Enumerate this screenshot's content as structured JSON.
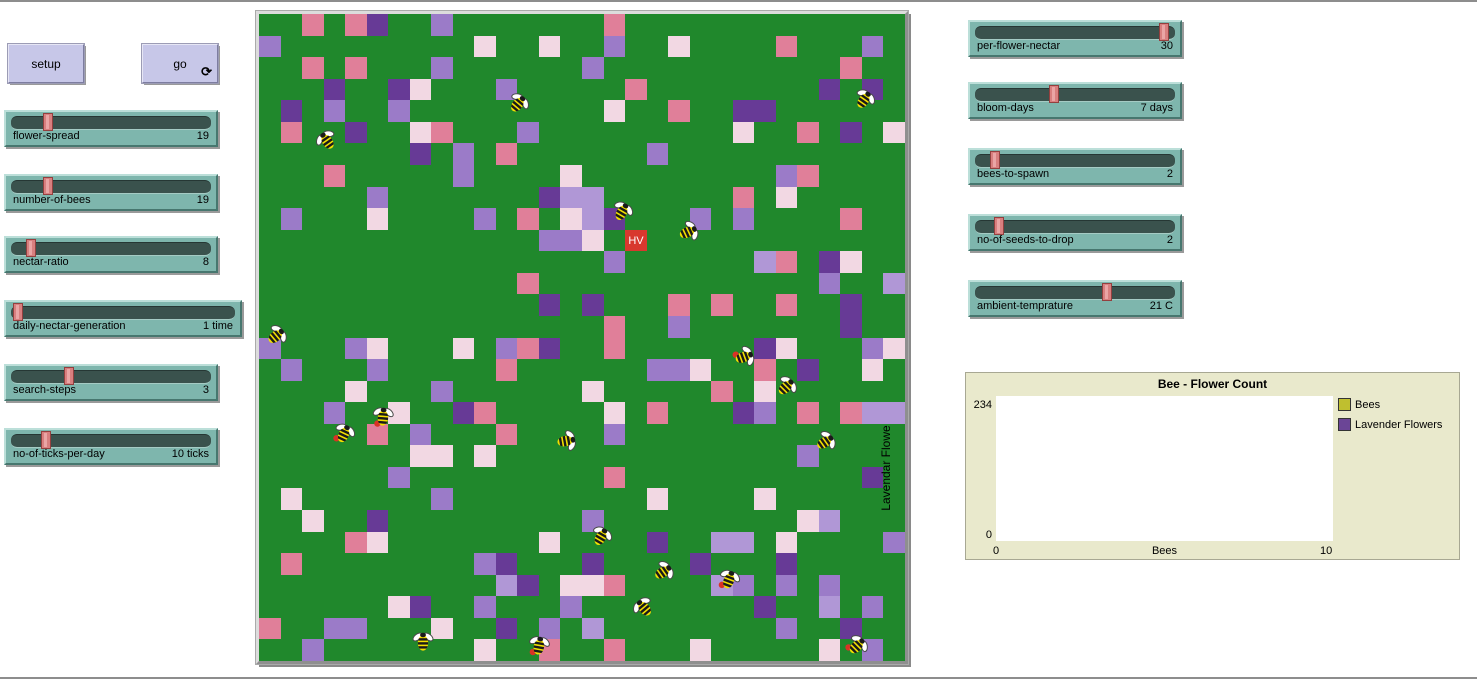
{
  "chrome": {
    "border_color": "#8d8d8d",
    "top_rule_y": 0,
    "bottom_rule_y": 677
  },
  "buttons": [
    {
      "id": "setup",
      "label": "setup",
      "x": 8,
      "y": 44,
      "w": 74,
      "h": 37,
      "forever": false,
      "forever_icon": ""
    },
    {
      "id": "go",
      "label": "go",
      "x": 142,
      "y": 44,
      "w": 74,
      "h": 37,
      "forever": true,
      "forever_icon": "⟳"
    }
  ],
  "sliders": [
    {
      "id": "flower-spread",
      "label": "flower-spread",
      "value": "19",
      "fraction": 0.17,
      "x": 4,
      "y": 110,
      "w": 214
    },
    {
      "id": "number-of-bees",
      "label": "number-of-bees",
      "value": "19",
      "fraction": 0.17,
      "x": 4,
      "y": 174,
      "w": 214
    },
    {
      "id": "nectar-ratio",
      "label": "nectar-ratio",
      "value": "8",
      "fraction": 0.08,
      "x": 4,
      "y": 236,
      "w": 214
    },
    {
      "id": "daily-nectar-generation",
      "label": "daily-nectar-generation",
      "value": "1 time",
      "fraction": 0.01,
      "x": 4,
      "y": 300,
      "w": 238
    },
    {
      "id": "search-steps",
      "label": "search-steps",
      "value": "3",
      "fraction": 0.28,
      "x": 4,
      "y": 364,
      "w": 214
    },
    {
      "id": "no-of-ticks-per-day",
      "label": "no-of-ticks-per-day",
      "value": "10 ticks",
      "fraction": 0.16,
      "x": 4,
      "y": 428,
      "w": 214
    },
    {
      "id": "per-flower-nectar",
      "label": "per-flower-nectar",
      "value": "30",
      "fraction": 0.97,
      "x": 968,
      "y": 20,
      "w": 214
    },
    {
      "id": "bloom-days",
      "label": "bloom-days",
      "value": "7 days",
      "fraction": 0.39,
      "x": 968,
      "y": 82,
      "w": 214
    },
    {
      "id": "bees-to-spawn",
      "label": "bees-to-spawn",
      "value": "2",
      "fraction": 0.08,
      "x": 968,
      "y": 148,
      "w": 214
    },
    {
      "id": "no-of-seeds-to-drop",
      "label": "no-of-seeds-to-drop",
      "value": "2",
      "fraction": 0.1,
      "x": 968,
      "y": 214,
      "w": 214
    },
    {
      "id": "ambient-temprature",
      "label": "ambient-temprature",
      "value": "21 C",
      "fraction": 0.67,
      "x": 968,
      "y": 280,
      "w": 214
    }
  ],
  "world": {
    "x": 256,
    "y": 11,
    "w": 652,
    "h": 653,
    "cols": 30,
    "rows": 30,
    "palette": {
      ".": "#20882c",
      "p": "#e07f99",
      "w": "#f2d8e3",
      "l": "#9b7bc8",
      "L": "#b097d6",
      "d": "#673a96"
    },
    "grid": [
      "..p.pd..l.......p.............",
      "l.........w..w..l..w....p...l.",
      "..p.p...l......l...........p..",
      "...d..dw...l.....p........d.d.",
      ".d.l..l.........w..p..dd......",
      ".p..d..wp...l.........w..p.d.w",
      ".......d.l.p......l...........",
      "...p.....l....w.........lp....",
      ".....l.......dLL......p.w.....",
      ".l...w....l.p.wLd...l.l....p..",
      ".............llw.H............",
      "................l......Lp.dw..",
      "............p.............l..L",
      ".............d.d...p.p..p..d..",
      "................p..l.......d..",
      "l...lw...w.lpd..p......dw...lw",
      ".l...l.....p......llw..p.d..w.",
      "....w...l......w.....p.w......",
      "...l..w..dp.....w.p...dl.p.pLL",
      ".....p.l...p....l.............",
      ".......ww.w..............l....",
      "......l.........p...........d.",
      ".w......l.........w....w......",
      "..w..d.........l.........wL...",
      "....pw.......w....d..LL.w....l",
      ".p........ld...d....d...d.....",
      "...........Ld.wwp....Ll.l.l...",
      "......wd..l...l........d..L.l.",
      "p..ll...w..d.l.L........l..d..",
      "..l.......w..p..p...w.....w.l."
    ],
    "hive": {
      "col": 17,
      "row": 10,
      "label": "HV",
      "color": "#d8382e"
    },
    "bee_colors": {
      "body": "#f2df00",
      "stripe": "#1a1a1a",
      "wing": "#ffffff",
      "nectar_dot": "#d93226"
    },
    "bees": [
      {
        "x": 518,
        "y": 104,
        "angle": 40,
        "nectar": false
      },
      {
        "x": 327,
        "y": 141,
        "angle": -35,
        "nectar": false
      },
      {
        "x": 864,
        "y": 100,
        "angle": 35,
        "nectar": false
      },
      {
        "x": 622,
        "y": 212,
        "angle": 30,
        "nectar": false
      },
      {
        "x": 688,
        "y": 232,
        "angle": 65,
        "nectar": false
      },
      {
        "x": 276,
        "y": 336,
        "angle": 50,
        "nectar": false
      },
      {
        "x": 744,
        "y": 357,
        "angle": 70,
        "nectar": true
      },
      {
        "x": 786,
        "y": 387,
        "angle": 45,
        "nectar": false
      },
      {
        "x": 383,
        "y": 417,
        "angle": 5,
        "nectar": true
      },
      {
        "x": 344,
        "y": 434,
        "angle": 25,
        "nectar": true
      },
      {
        "x": 566,
        "y": 441,
        "angle": 80,
        "nectar": false
      },
      {
        "x": 825,
        "y": 442,
        "angle": 55,
        "nectar": false
      },
      {
        "x": 601,
        "y": 537,
        "angle": 30,
        "nectar": false
      },
      {
        "x": 663,
        "y": 572,
        "angle": 55,
        "nectar": false
      },
      {
        "x": 729,
        "y": 580,
        "angle": 20,
        "nectar": true
      },
      {
        "x": 644,
        "y": 608,
        "angle": -40,
        "nectar": false
      },
      {
        "x": 423,
        "y": 642,
        "angle": 0,
        "nectar": false
      },
      {
        "x": 539,
        "y": 646,
        "angle": 10,
        "nectar": true
      },
      {
        "x": 857,
        "y": 646,
        "angle": 45,
        "nectar": true
      }
    ]
  },
  "plot": {
    "x": 965,
    "y": 372,
    "w": 495,
    "h": 188,
    "title": "Bee - Flower Count",
    "y_axis_title": "Lavendar Flowe",
    "y_max": "234",
    "y_min": "0",
    "x_min": "0",
    "x_max": "10",
    "x_axis_title": "Bees",
    "area": {
      "left": 30,
      "top": 23,
      "w": 337,
      "h": 145
    },
    "legend": [
      {
        "label": "Bees",
        "color": "#bfbf2f"
      },
      {
        "label": "Lavender Flowers",
        "color": "#6b4596"
      }
    ]
  },
  "chart_data": {
    "type": "line",
    "title": "Bee - Flower Count",
    "xlabel": "Bees",
    "ylabel": "Lavendar Flowe",
    "xlim": [
      0,
      10
    ],
    "ylim": [
      0,
      234
    ],
    "grid": false,
    "legend_position": "right",
    "series": [
      {
        "name": "Bees",
        "color": "#bfbf2f",
        "points": []
      },
      {
        "name": "Lavender Flowers",
        "color": "#6b4596",
        "points": []
      }
    ]
  }
}
